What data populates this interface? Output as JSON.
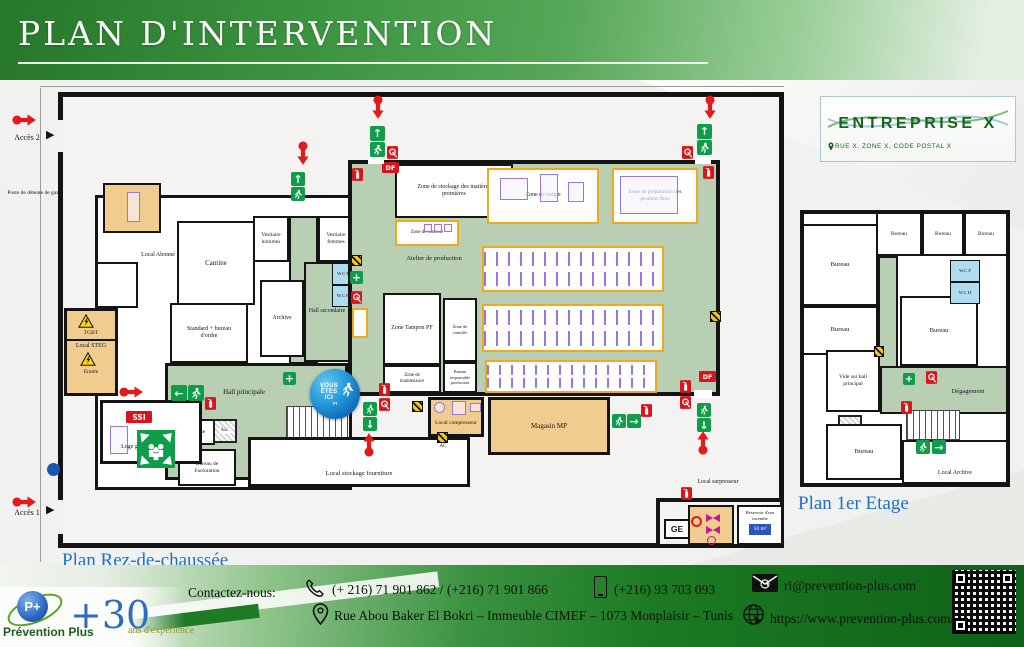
{
  "header": {
    "title": "PLAN D'INTERVENTION"
  },
  "company": {
    "name": "ENTREPRISE X",
    "address": "RUE X, ZONE X, CODE POSTAL X"
  },
  "captions": {
    "ground": "Plan Rez-de-chaussée",
    "first": "Plan 1er Etage"
  },
  "access": {
    "a2": "Accès 2",
    "a1": "Accès 1"
  },
  "gf": {
    "poste_gaz": "Poste de détente de gaz",
    "local_abonne": "Local Abonné",
    "tgbt": "TGBT",
    "local_steg": "Local STEG",
    "entree": "Entrée",
    "loge_gardien": "Loge gardien",
    "cantine": "Cantine",
    "standard": "Standard + bureau d'ordre",
    "vestiaire_h": "Vestiaire hommes",
    "vestiaire_f": "Vestiaire femmes",
    "wcf": "W.C F",
    "wch": "W.C H",
    "archive": "Archive",
    "hall_secondaire": "Hall secondaire",
    "hall_principale": "Hall principale",
    "caisse": "Caisse",
    "asc": "Asc.",
    "bureau_fact": "Bureau de Facturation",
    "local_stockage": "Local stockage fourniture",
    "atelier": "Atelier de production",
    "zone_stockage": "Zone de stockage des matières premières",
    "zone_coupe": "Zone de coupe",
    "zone_prep": "Zone de préparation des produits finis",
    "zone_controle": "Zone de contrôle",
    "zone_tampon": "Zone Tampon PF",
    "zone_maintenance": "Zone de maintenance",
    "bureau_resp": "Bureau responsable production",
    "local_compresseur": "Local compresseur",
    "magasin": "Magasin MP",
    "local_surpresseur": "Local surpresseur",
    "reservoir": "Réservoir d'eau incendie",
    "tank": "50 m³"
  },
  "ff": {
    "bureau": "Bureau",
    "wcf": "W.C F",
    "wch": "W.C H",
    "vide": "Vide sur hall principal",
    "degagement": "Dégagement",
    "asc": "Asc.",
    "local_archive": "Local Archive"
  },
  "badges": {
    "df": "DF",
    "ssi": "SSI",
    "ge": "GE",
    "ac": "AC"
  },
  "yah": {
    "l1": "VOUS",
    "l2": "ÊTES",
    "l3": "ICI",
    "sub": "PI"
  },
  "icons": {
    "up": "↑",
    "down": "↓",
    "left": "←",
    "right": "→",
    "plus": "+",
    "tri": "▶"
  },
  "footer": {
    "contact_label": "Contactez-nous:",
    "phones": "(+ 216) 71 901 862 / (+216) 71 901 866",
    "mobile": "(+216) 93 703 093",
    "email": "ri@prevention-plus.com",
    "address": "Rue Abou Baker El Bokri – Immeuble CIMEF – 1073 Monplaisir – Tunis",
    "website": "https://www.prevention-plus.com/"
  },
  "logo": {
    "brand": "Prévention Plus",
    "monogram": "P+",
    "years": "+30",
    "exp": "ans d'expérience"
  }
}
